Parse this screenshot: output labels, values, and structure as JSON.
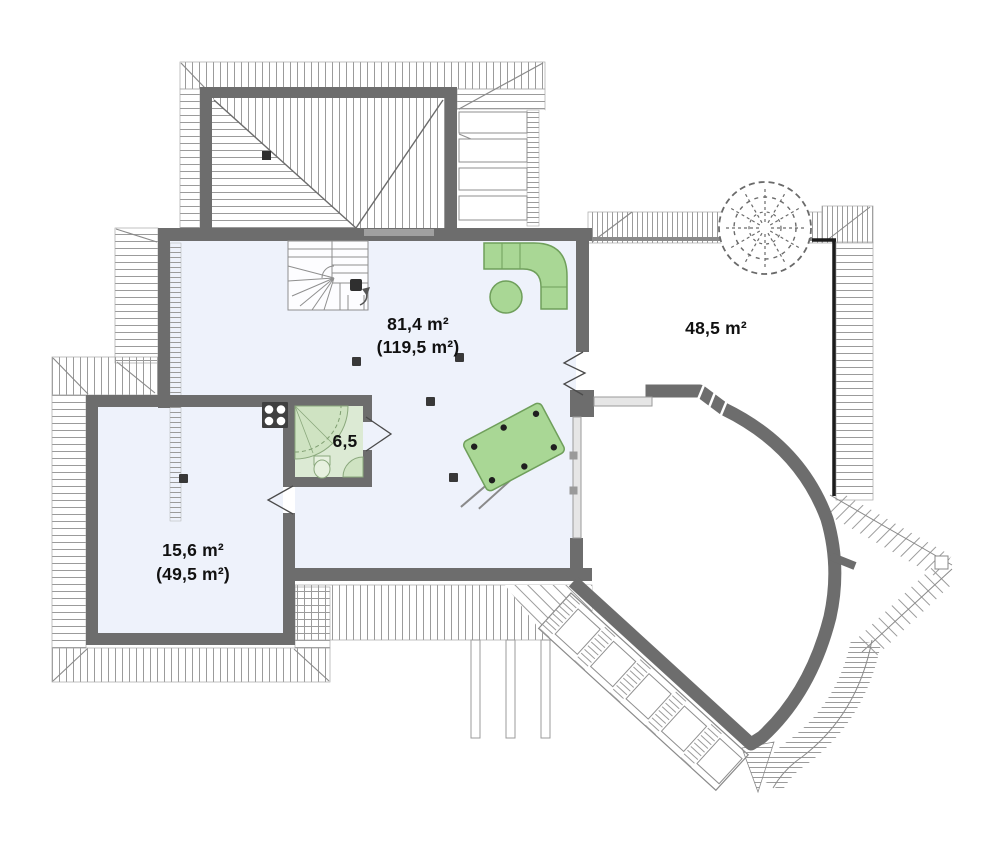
{
  "plan": {
    "type": "floor-plan-upper-storey",
    "rooms": {
      "living": {
        "area": "81,4 m²",
        "total": "(119,5 m²)"
      },
      "terrace": {
        "area": "48,5 m²"
      },
      "bathroom": {
        "area": "6,5"
      },
      "bedroom": {
        "area": "15,6 m²",
        "total": "(49,5 m²)"
      }
    },
    "colors": {
      "wall": "#6d6d6d",
      "room_fill": "#eef2fb",
      "bathroom_floor": "#dcead4",
      "furniture_fill": "#a9d795",
      "furniture_stroke": "#6f9f5b",
      "fixture_fill": "#cfe3c2",
      "hatch_line": "#9b9b9b",
      "outline_black": "#1c1c1c",
      "glass_fill": "#e6e6e6",
      "label": "#111111"
    }
  }
}
